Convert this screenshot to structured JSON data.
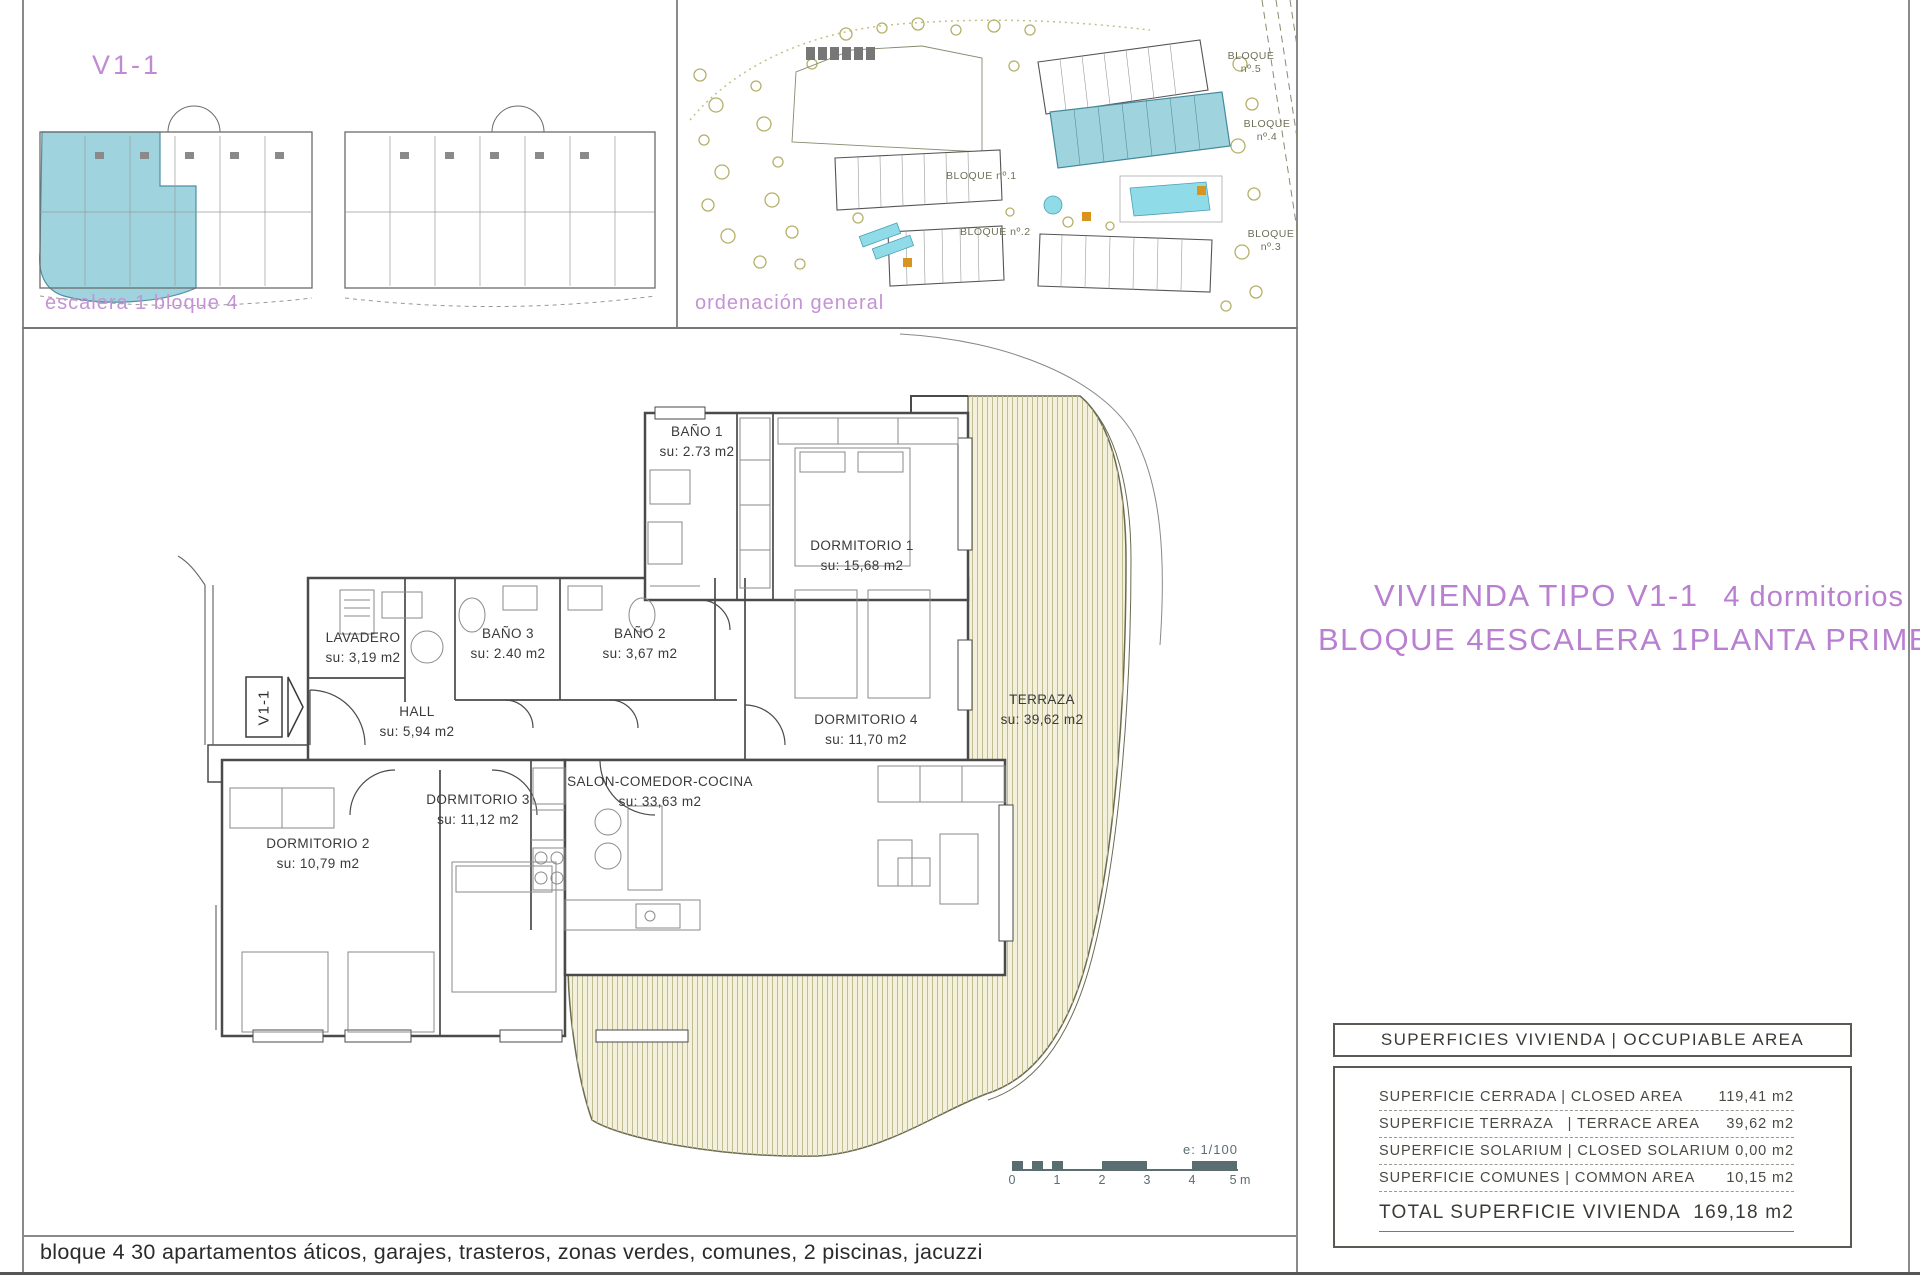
{
  "locator_panel": {
    "title": "V1-1",
    "caption": "escalera 1 bloque 4"
  },
  "site_panel": {
    "caption": "ordenación general",
    "block_labels": [
      "BLOQUE nº.5",
      "BLOQUE nº.4",
      "BLOQUE nº.1",
      "BLOQUE nº.2",
      "BLOQUE nº.3"
    ]
  },
  "floor_plan": {
    "unit_tag": "V1-1",
    "rooms": [
      {
        "name": "BAÑO 1",
        "area": "su: 2.73 m2"
      },
      {
        "name": "DORMITORIO 1",
        "area": "su: 15,68 m2"
      },
      {
        "name": "LAVADERO",
        "area": "su: 3,19 m2"
      },
      {
        "name": "BAÑO 3",
        "area": "su: 2.40 m2"
      },
      {
        "name": "BAÑO 2",
        "area": "su: 3,67 m2"
      },
      {
        "name": "HALL",
        "area": "su: 5,94 m2"
      },
      {
        "name": "DORMITORIO 4",
        "area": "su: 11,70 m2"
      },
      {
        "name": "TERRAZA",
        "area": "su: 39,62 m2"
      },
      {
        "name": "SALON-COMEDOR-COCINA",
        "area": "su: 33,63 m2"
      },
      {
        "name": "DORMITORIO 3",
        "area": "su: 11,12 m2"
      },
      {
        "name": "DORMITORIO 2",
        "area": "su: 10,79 m2"
      }
    ]
  },
  "title_block": {
    "line1_left": "VIVIENDA TIPO V1-1",
    "line1_right": "4 dormitorios",
    "line2_parts": [
      "BLOQUE 4",
      "ESCALERA 1",
      "PLANTA PRIMERA"
    ]
  },
  "areas_table": {
    "header": "SUPERFICIES VIVIENDA | OCCUPIABLE AREA",
    "rows": [
      {
        "label": "SUPERFICIE CERRADA | CLOSED AREA",
        "value": "119,41 m2"
      },
      {
        "label": "SUPERFICIE TERRAZA   | TERRACE AREA",
        "value": "39,62 m2"
      },
      {
        "label": "SUPERFICIE SOLARIUM | CLOSED SOLARIUM",
        "value": "0,00 m2"
      },
      {
        "label": "SUPERFICIE COMUNES | COMMON AREA",
        "value": "10,15 m2"
      }
    ],
    "total": {
      "label": "TOTAL SUPERFICIE VIVIENDA",
      "value": "169,18 m2"
    }
  },
  "scale_bar": {
    "scale_text": "e: 1/100",
    "ticks": [
      "0",
      "1",
      "2",
      "3",
      "4",
      "5 m"
    ]
  },
  "footer": {
    "text": "bloque 4 30 apartamentos áticos, garajes, trasteros, zonas verdes, comunes, 2 piscinas, jacuzzi"
  },
  "colors": {
    "accent_purple": "#b97fd0",
    "highlight_blue": "#9fd4df",
    "terrace_fill": "#f3f0dc",
    "pool_cyan": "#8fdbe8"
  }
}
